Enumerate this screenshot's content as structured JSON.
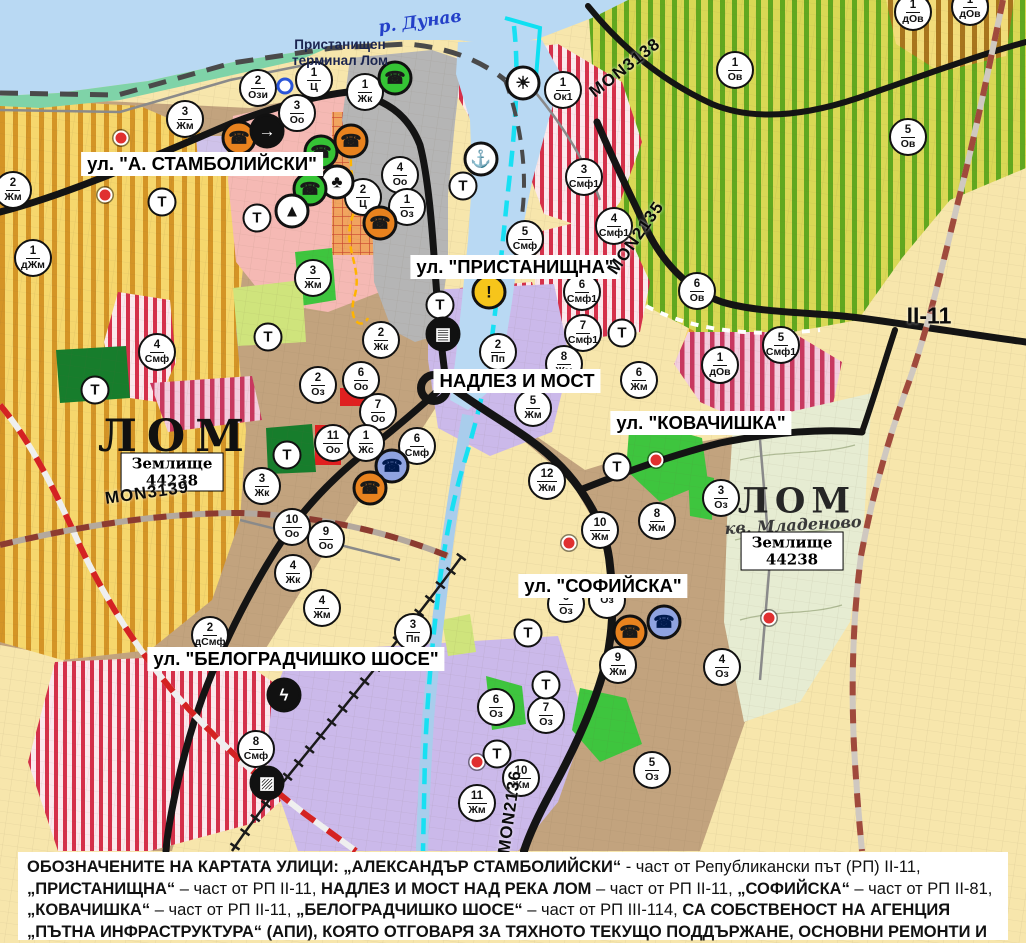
{
  "map": {
    "size": {
      "width": 1026,
      "height": 943
    },
    "colors": {
      "water": "#b9d9f3",
      "river_highlight": "#0fe0f2",
      "urban_tan": "#c2a37e",
      "cadastral_cream": "#f7e6ac",
      "vineyard_stripe": "#d49426",
      "orchard_stripe": "#61a81f",
      "smf_stripe": "#d5304a",
      "industrial_purple": "#cbb9ea",
      "park_green": "#3ec53e",
      "road_black": "#141414",
      "boundary_red": "#d42222",
      "center_pink": "#f5b9b4"
    },
    "street_labels": [
      {
        "id": "stambolijski",
        "text": "ул. \"А. СТАМБОЛИЙСКИ\"",
        "cx": 202,
        "cy": 164
      },
      {
        "id": "pristanishtna",
        "text": "ул. \"ПРИСТАНИЩНА\"",
        "cx": 515,
        "cy": 267
      },
      {
        "id": "nadlez-i-most",
        "text": "НАДЛЕЗ И МОСТ",
        "cx": 517,
        "cy": 381
      },
      {
        "id": "kovachishka",
        "text": "ул. \"КОВАЧИШКА\"",
        "cx": 701,
        "cy": 423
      },
      {
        "id": "sofiyska",
        "text": "ул. \"СОФИЙСКА\"",
        "cx": 603,
        "cy": 586
      },
      {
        "id": "belogradchishko-shose",
        "text": "ул. \"БЕЛОГРАДЧИШКО ШОСЕ\"",
        "cx": 296,
        "cy": 659
      }
    ],
    "area_labels": [
      {
        "id": "r-dunav",
        "text": "р. Дунав",
        "cx": 420,
        "cy": 22,
        "cls": "river",
        "rot": -8
      },
      {
        "id": "port-terminal",
        "text": "Пристанищен\nтерминал Лом",
        "cx": 340,
        "cy": 53,
        "cls": "terminal",
        "rot": 0
      },
      {
        "id": "lom-west",
        "text": "ЛОМ",
        "cx": 176,
        "cy": 437,
        "cls": "city",
        "rot": 0
      },
      {
        "id": "zemlishte-west",
        "text": "Землище\n44238",
        "cx": 172,
        "cy": 472,
        "cls": "boxed",
        "rot": 0
      },
      {
        "id": "mon3139",
        "text": "MON3139",
        "cx": 147,
        "cy": 493,
        "cls": "road",
        "rot": -8
      },
      {
        "id": "mon3138",
        "text": "MON3138",
        "cx": 625,
        "cy": 68,
        "cls": "road",
        "rot": -38
      },
      {
        "id": "mon2135",
        "text": "MON2135",
        "cx": 636,
        "cy": 238,
        "cls": "road",
        "rot": -55
      },
      {
        "id": "mon2136",
        "text": "MON2136",
        "cx": 510,
        "cy": 812,
        "cls": "road",
        "rot": -82
      },
      {
        "id": "ii-11",
        "text": "II-11",
        "cx": 929,
        "cy": 316,
        "cls": "road big",
        "rot": 0
      },
      {
        "id": "lom-east",
        "text": "ЛОМ",
        "cx": 797,
        "cy": 501,
        "cls": "city east",
        "rot": 0
      },
      {
        "id": "kv-mladenovo",
        "text": "кв. Младеново",
        "cx": 793,
        "cy": 525,
        "cls": "quarter",
        "rot": -3
      },
      {
        "id": "zemlishte-east",
        "text": "Землище\n44238",
        "cx": 792,
        "cy": 551,
        "cls": "boxed",
        "rot": 0
      }
    ],
    "zone_markers": [
      {
        "num": "2",
        "code": "Ози",
        "x": 258,
        "y": 88
      },
      {
        "num": "1",
        "code": "Ц",
        "x": 314,
        "y": 80
      },
      {
        "num": "1",
        "code": "Жк",
        "x": 365,
        "y": 92
      },
      {
        "num": "3",
        "code": "Оо",
        "x": 297,
        "y": 113
      },
      {
        "num": "3",
        "code": "Жм",
        "x": 185,
        "y": 119
      },
      {
        "num": "2",
        "code": "Жм",
        "x": 13,
        "y": 190
      },
      {
        "num": "1",
        "code": "дЖм",
        "x": 33,
        "y": 258
      },
      {
        "num": "4",
        "code": "Смф",
        "x": 157,
        "y": 352
      },
      {
        "num": "1",
        "code": "Ок1",
        "x": 563,
        "y": 90
      },
      {
        "num": "1",
        "code": "Ов",
        "x": 735,
        "y": 70
      },
      {
        "num": "1",
        "code": "дОв",
        "x": 913,
        "y": 12
      },
      {
        "num": "1",
        "code": "дОв",
        "x": 970,
        "y": 7
      },
      {
        "num": "5",
        "code": "Ов",
        "x": 908,
        "y": 137
      },
      {
        "num": "6",
        "code": "Ов",
        "x": 697,
        "y": 291
      },
      {
        "num": "4",
        "code": "Оо",
        "x": 400,
        "y": 175
      },
      {
        "num": "2",
        "code": "Ц",
        "x": 363,
        "y": 197
      },
      {
        "num": "1",
        "code": "Оз",
        "x": 407,
        "y": 207
      },
      {
        "num": "3",
        "code": "Жм",
        "x": 313,
        "y": 278
      },
      {
        "num": "2",
        "code": "Жк",
        "x": 381,
        "y": 340
      },
      {
        "num": "2",
        "code": "Оз",
        "x": 318,
        "y": 385
      },
      {
        "num": "6",
        "code": "Оо",
        "x": 361,
        "y": 380
      },
      {
        "num": "7",
        "code": "Оо",
        "x": 378,
        "y": 412
      },
      {
        "num": "11",
        "code": "Оо",
        "x": 333,
        "y": 443
      },
      {
        "num": "1",
        "code": "Жс",
        "x": 366,
        "y": 443
      },
      {
        "num": "6",
        "code": "Смф",
        "x": 417,
        "y": 446
      },
      {
        "num": "3",
        "code": "Жк",
        "x": 262,
        "y": 486
      },
      {
        "num": "10",
        "code": "Оо",
        "x": 292,
        "y": 527
      },
      {
        "num": "9",
        "code": "Оо",
        "x": 326,
        "y": 539
      },
      {
        "num": "4",
        "code": "Жк",
        "x": 293,
        "y": 573
      },
      {
        "num": "4",
        "code": "Жм",
        "x": 322,
        "y": 608
      },
      {
        "num": "2",
        "code": "дСмф",
        "x": 210,
        "y": 635
      },
      {
        "num": "3",
        "code": "Пп",
        "x": 413,
        "y": 632
      },
      {
        "num": "8",
        "code": "Смф",
        "x": 256,
        "y": 749
      },
      {
        "num": "2",
        "code": "Пп",
        "x": 498,
        "y": 352
      },
      {
        "num": "5",
        "code": "Смф",
        "x": 525,
        "y": 239
      },
      {
        "num": "3",
        "code": "Смф1",
        "x": 584,
        "y": 177
      },
      {
        "num": "4",
        "code": "Смф1",
        "x": 614,
        "y": 226
      },
      {
        "num": "6",
        "code": "Смф1",
        "x": 582,
        "y": 292
      },
      {
        "num": "7",
        "code": "Смф1",
        "x": 583,
        "y": 333
      },
      {
        "num": "5",
        "code": "Смф1",
        "x": 781,
        "y": 345
      },
      {
        "num": "1",
        "code": "дОв",
        "x": 720,
        "y": 365
      },
      {
        "num": "8",
        "code": "Жм",
        "x": 564,
        "y": 364
      },
      {
        "num": "5",
        "code": "Жм",
        "x": 533,
        "y": 408
      },
      {
        "num": "6",
        "code": "Жм",
        "x": 639,
        "y": 380
      },
      {
        "num": "8",
        "code": "Жм",
        "x": 657,
        "y": 521
      },
      {
        "num": "3",
        "code": "Оз",
        "x": 721,
        "y": 498
      },
      {
        "num": "12",
        "code": "Жм",
        "x": 547,
        "y": 481
      },
      {
        "num": "10",
        "code": "Жм",
        "x": 600,
        "y": 530
      },
      {
        "num": "6",
        "code": "Оз",
        "x": 566,
        "y": 604
      },
      {
        "num": "",
        "code": "Оз",
        "x": 607,
        "y": 600
      },
      {
        "num": "9",
        "code": "Жм",
        "x": 618,
        "y": 665
      },
      {
        "num": "4",
        "code": "Оз",
        "x": 722,
        "y": 667
      },
      {
        "num": "6",
        "code": "Оз",
        "x": 496,
        "y": 707
      },
      {
        "num": "7",
        "code": "Оз",
        "x": 546,
        "y": 715
      },
      {
        "num": "10",
        "code": "Жм",
        "x": 521,
        "y": 778
      },
      {
        "num": "11",
        "code": "Жм",
        "x": 477,
        "y": 803
      },
      {
        "num": "5",
        "code": "Оз",
        "x": 652,
        "y": 770
      }
    ],
    "t_label": "Т",
    "t_markers": [
      {
        "x": 162,
        "y": 202
      },
      {
        "x": 257,
        "y": 218
      },
      {
        "x": 268,
        "y": 337
      },
      {
        "x": 287,
        "y": 455
      },
      {
        "x": 95,
        "y": 390
      },
      {
        "x": 440,
        "y": 305
      },
      {
        "x": 463,
        "y": 186
      },
      {
        "x": 622,
        "y": 333
      },
      {
        "x": 617,
        "y": 467
      },
      {
        "x": 528,
        "y": 633
      },
      {
        "x": 546,
        "y": 685
      },
      {
        "x": 497,
        "y": 754
      }
    ],
    "icon_styles": {
      "factory-icon-orange": {
        "glyph": "☎",
        "bg": "#e8821e",
        "fg": "#1a1a1a"
      },
      "factory-icon-green": {
        "glyph": "☎",
        "bg": "#35c435",
        "fg": "#1a1a1a"
      },
      "factory-icon-blue": {
        "glyph": "☎",
        "bg": "#8fa3e0",
        "fg": "#001a4d"
      },
      "parking-arrow-icon": {
        "glyph": "→",
        "bg": "#111111",
        "fg": "#ffffff"
      },
      "community-icon": {
        "glyph": "♣",
        "bg": "#ffffff",
        "fg": "#111111"
      },
      "monument-icon": {
        "glyph": "▲",
        "bg": "#ffffff",
        "fg": "#111111"
      },
      "sun-icon": {
        "glyph": "☀",
        "bg": "#ffffff",
        "fg": "#111111"
      },
      "anchor-icon": {
        "glyph": "⚓",
        "bg": "#ffffff",
        "fg": "#111111"
      },
      "warning-icon": {
        "glyph": "!",
        "bg": "#f6c51b",
        "fg": "#111111"
      },
      "bus-icon": {
        "glyph": "▤",
        "bg": "#111111",
        "fg": "#ffffff"
      },
      "lightning-icon": {
        "glyph": "ϟ",
        "bg": "#111111",
        "fg": "#ffffff"
      },
      "railway-icon": {
        "glyph": "▨",
        "bg": "#111111",
        "fg": "#ffffff"
      }
    },
    "icon_markers": [
      {
        "name": "factory-icon-orange",
        "x": 239,
        "y": 138
      },
      {
        "name": "parking-arrow-icon",
        "x": 267,
        "y": 131
      },
      {
        "name": "factory-icon-green",
        "x": 395,
        "y": 78
      },
      {
        "name": "factory-icon-green",
        "x": 321,
        "y": 152
      },
      {
        "name": "factory-icon-orange",
        "x": 351,
        "y": 141
      },
      {
        "name": "community-icon",
        "x": 337,
        "y": 182
      },
      {
        "name": "factory-icon-green",
        "x": 310,
        "y": 189
      },
      {
        "name": "monument-icon",
        "x": 292,
        "y": 211
      },
      {
        "name": "factory-icon-orange",
        "x": 380,
        "y": 223
      },
      {
        "name": "sun-icon",
        "x": 523,
        "y": 83
      },
      {
        "name": "anchor-icon",
        "x": 481,
        "y": 159
      },
      {
        "name": "warning-icon",
        "x": 489,
        "y": 292
      },
      {
        "name": "bus-icon",
        "x": 443,
        "y": 334
      },
      {
        "name": "factory-icon-blue",
        "x": 392,
        "y": 466
      },
      {
        "name": "factory-icon-orange",
        "x": 370,
        "y": 488
      },
      {
        "name": "factory-icon-orange",
        "x": 630,
        "y": 632
      },
      {
        "name": "factory-icon-blue",
        "x": 664,
        "y": 622
      },
      {
        "name": "lightning-icon",
        "x": 284,
        "y": 695
      },
      {
        "name": "railway-icon",
        "x": 267,
        "y": 783
      }
    ],
    "red_dots": [
      {
        "x": 121,
        "y": 138
      },
      {
        "x": 105,
        "y": 195
      },
      {
        "x": 569,
        "y": 543
      },
      {
        "x": 656,
        "y": 460
      },
      {
        "x": 769,
        "y": 618
      },
      {
        "x": 477,
        "y": 762
      }
    ],
    "blue_dots": [
      {
        "x": 285,
        "y": 86
      }
    ]
  },
  "legend": {
    "segments": [
      {
        "b": true,
        "t": "ОБОЗНАЧЕНИТЕ НА КАРТАТА УЛИЦИ: „АЛЕКСАНДЪР СТАМБОЛИЙСКИ“"
      },
      {
        "b": false,
        "t": " - част от Републикански път (РП) II-11, "
      },
      {
        "b": true,
        "t": "„ПРИСТАНИЩНА“"
      },
      {
        "b": false,
        "t": " – част от РП II-11, "
      },
      {
        "b": true,
        "t": "НАДЛЕЗ И МОСТ НАД РЕКА ЛОМ"
      },
      {
        "b": false,
        "t": " – част от РП II-11, "
      },
      {
        "b": true,
        "t": "„СОФИЙСКА“"
      },
      {
        "b": false,
        "t": " – част от РП II-81, "
      },
      {
        "b": true,
        "t": "„КОВАЧИШКА“"
      },
      {
        "b": false,
        "t": " – част от РП II-11, "
      },
      {
        "b": true,
        "t": "„БЕЛОГРАДЧИШКО ШОСЕ“"
      },
      {
        "b": false,
        "t": " – част от РП III-114, "
      },
      {
        "b": true,
        "t": "СА СОБСТВЕНОСТ НА АГЕНЦИЯ „ПЪТНА ИНФРАСТРУКТУРА“ (АПИ), КОЯТО ОТГОВАРЯ ЗА ТЯХНОТО ТЕКУЩО ПОДДЪРЖАНЕ, ОСНОВНИ РЕМОНТИ И РАЗРЕШИТЕЛНИ РЕЖИМИ."
      }
    ]
  }
}
